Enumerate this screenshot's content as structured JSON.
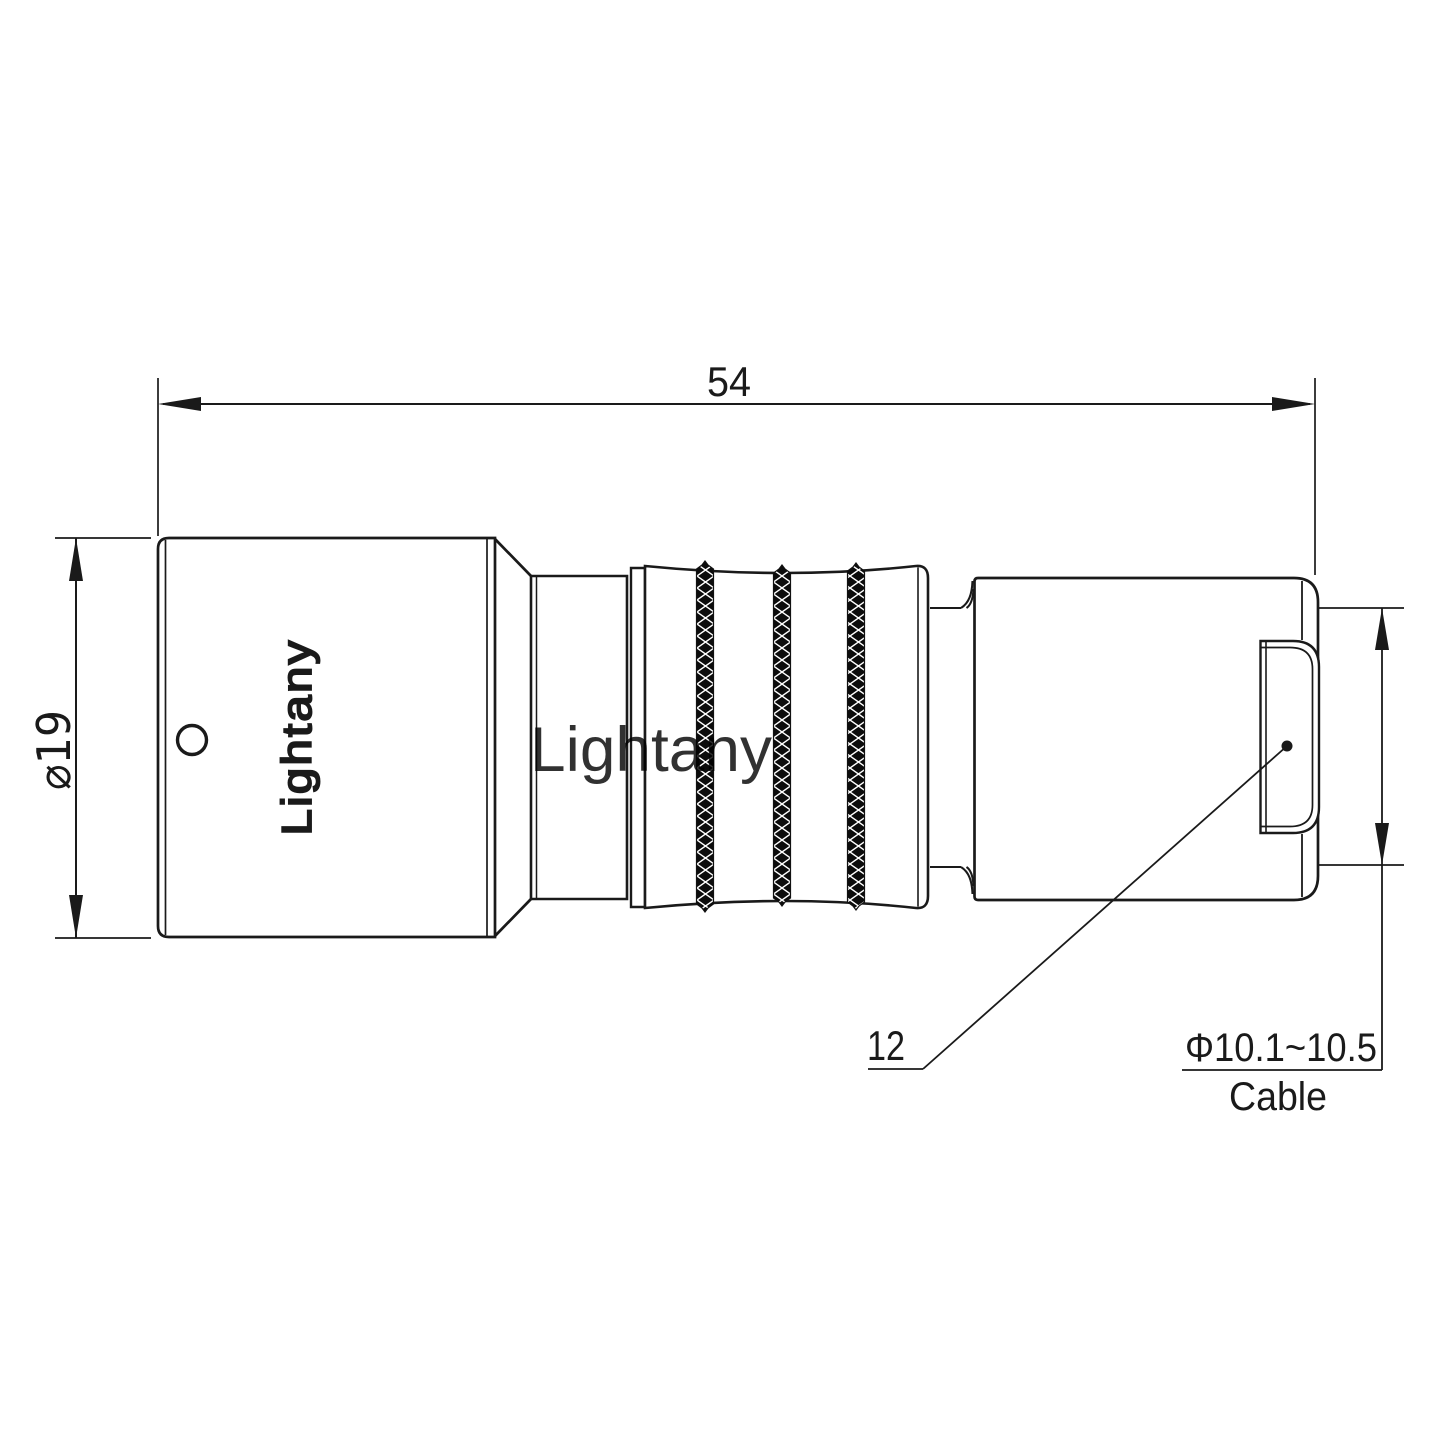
{
  "drawing": {
    "type": "connector-technical-drawing-side-view",
    "labels": {
      "overall_length": "54",
      "body_diameter": "⌀19",
      "leader": "12",
      "cable_diameter_range": "Φ10.1~10.5",
      "cable_caption": "Cable"
    },
    "engraving": "Lightany",
    "watermark": "Lightany",
    "colors": {
      "line": "#1a1a1a",
      "knurl_fill": "#0c0c0c",
      "watermark": "#eebcbc",
      "background": "#ffffff"
    }
  }
}
